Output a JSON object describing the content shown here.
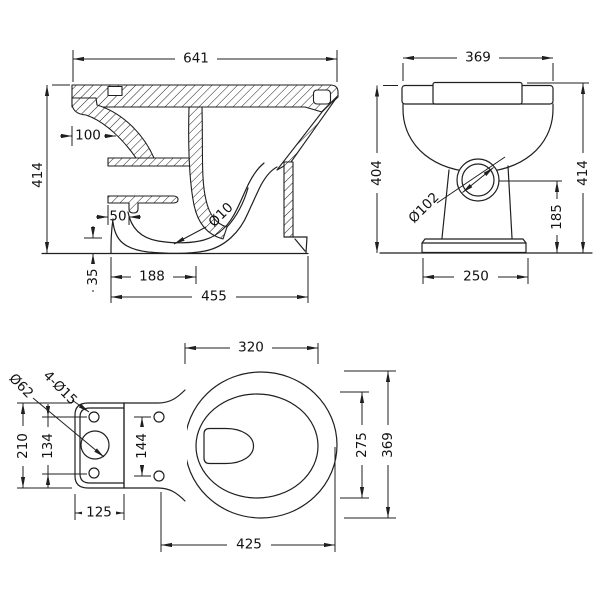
{
  "drawing": {
    "background": "#ffffff",
    "line_color": "#1f1f1f"
  },
  "side_view": {
    "length": "641",
    "height": "414",
    "inlet_depth": "100",
    "channel_width": "50",
    "trap_radius": "Ø10",
    "plinth_height": "35",
    "trap_length": "188",
    "foot_depth": "455"
  },
  "front_view": {
    "width": "369",
    "rim_height": "404",
    "seat_height": "414",
    "outlet_diameter": "Ø102",
    "outlet_height": "185",
    "base_width": "250"
  },
  "plan_view": {
    "bowl_inner_width": "320",
    "inlet_hole_diameter": "Ø62",
    "fixing_holes": "4-Ø15",
    "plate_length": "210",
    "plate_hole_pitch": "134",
    "seat_hole_pitch": "144",
    "plate_width": "125",
    "bowl_length": "425",
    "bowl_inner_length": "275",
    "bowl_outer_width": "369"
  }
}
